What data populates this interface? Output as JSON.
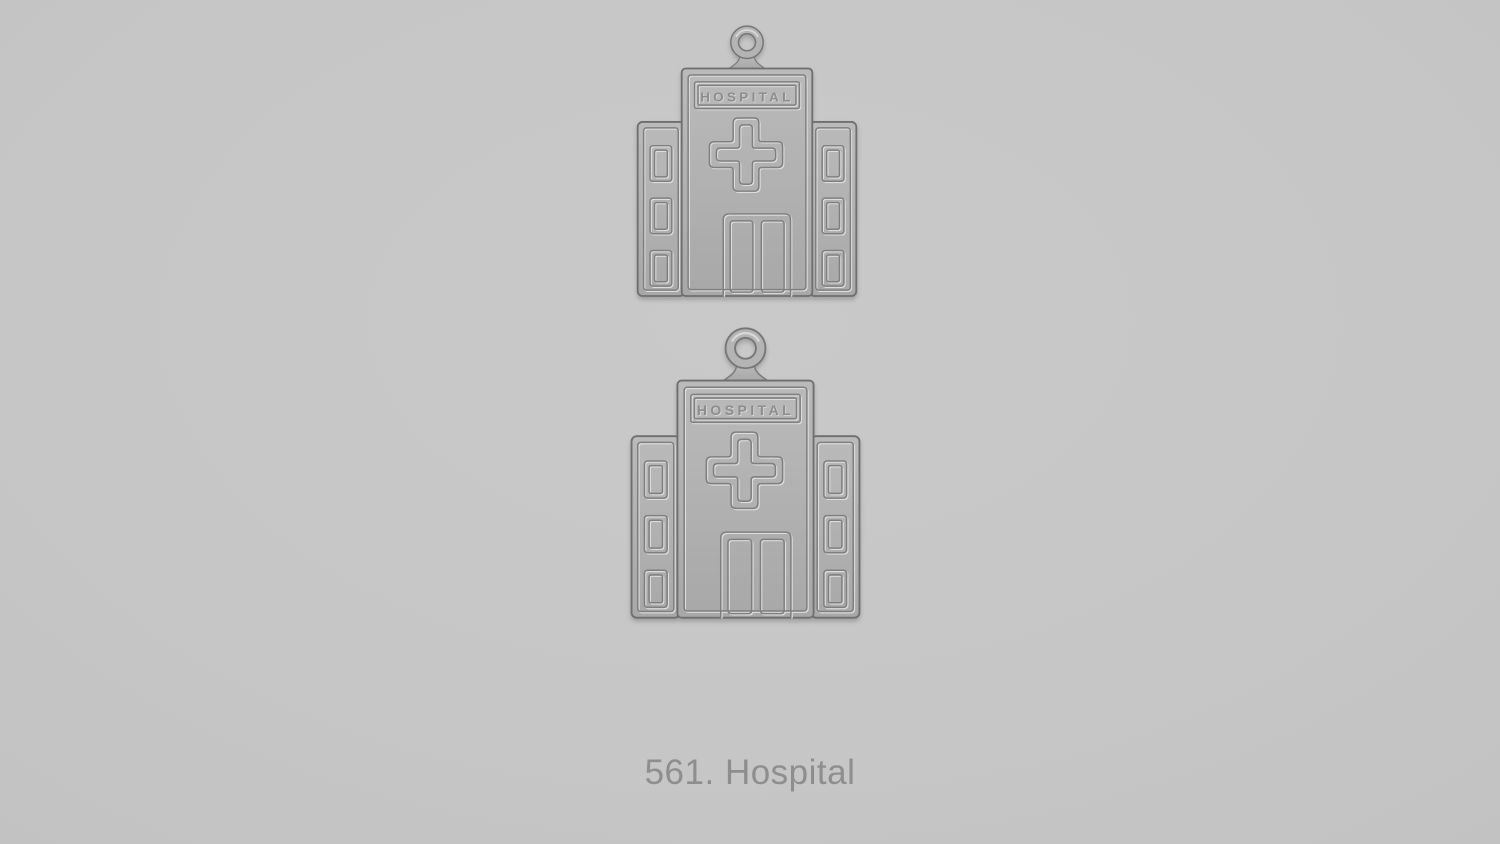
{
  "scene": {
    "caption": "561. Hospital",
    "item_number": "561",
    "item_name": "Hospital",
    "background_color": "#c6c6c6",
    "caption_color": "#8e8e8e"
  },
  "charms": [
    {
      "name": "hospital-charm-top",
      "sign_text": "HOSPITAL"
    },
    {
      "name": "hospital-charm-bottom",
      "sign_text": "HOSPITAL"
    }
  ],
  "colors": {
    "metal_base": "#b1b1b1",
    "metal_highlight": "#dcdcdc",
    "metal_shadow": "#7f7f7f",
    "outline": "#6f6f6f"
  }
}
